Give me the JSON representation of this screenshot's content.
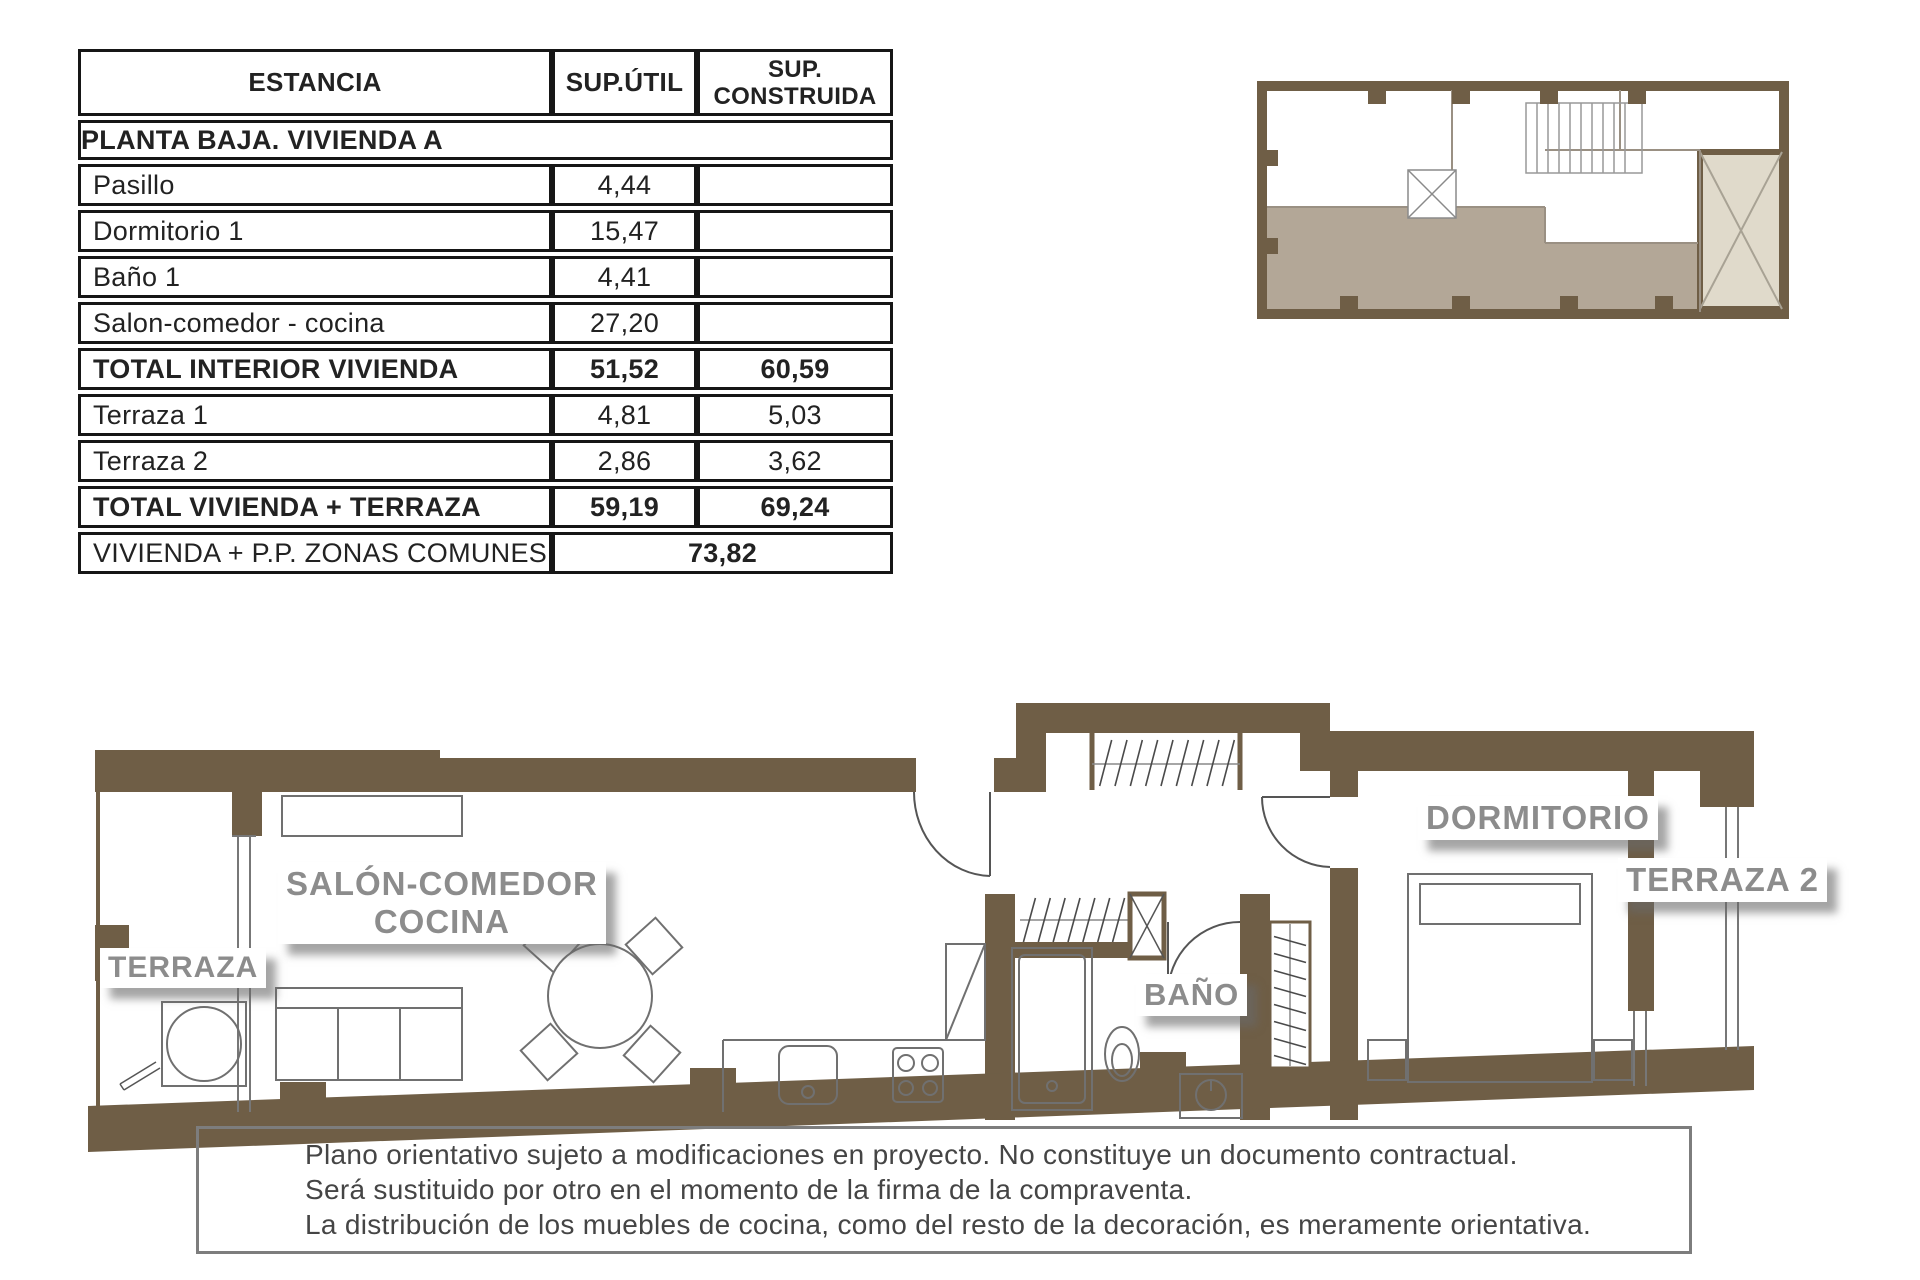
{
  "area_table": {
    "col_headers": {
      "estancia": "ESTANCIA",
      "sup_util": "SUP.ÚTIL",
      "sup_construida": "SUP. CONSTRUIDA"
    },
    "section_header": "PLANTA BAJA.    VIVIENDA A",
    "rows": [
      {
        "label": "Pasillo",
        "util": "4,44",
        "construida": "",
        "bold": false
      },
      {
        "label": "Dormitorio 1",
        "util": "15,47",
        "construida": "",
        "bold": false
      },
      {
        "label": "Baño 1",
        "util": "4,41",
        "construida": "",
        "bold": false
      },
      {
        "label": "Salon-comedor - cocina",
        "util": "27,20",
        "construida": "",
        "bold": false
      },
      {
        "label": "TOTAL INTERIOR VIVIENDA",
        "util": "51,52",
        "construida": "60,59",
        "bold": true
      },
      {
        "label": "Terraza 1",
        "util": "4,81",
        "construida": "5,03",
        "bold": false
      },
      {
        "label": "Terraza 2",
        "util": "2,86",
        "construida": "3,62",
        "bold": false
      },
      {
        "label": "TOTAL VIVIENDA + TERRAZA",
        "util": "59,19",
        "construida": "69,24",
        "bold": true
      }
    ],
    "footer_row": {
      "label": "VIVIENDA + P.P. ZONAS COMUNES",
      "value": "73,82"
    }
  },
  "floor_plan": {
    "labels": {
      "terraza": "TERRAZA",
      "salon_line1": "SALÓN-COMEDOR",
      "salon_line2": "COCINA",
      "bano": "BAÑO",
      "dormitorio": "DORMITORIO",
      "terraza2": "TERRAZA 2"
    }
  },
  "disclaimer": {
    "lines": [
      "Plano orientativo sujeto a modificaciones en proyecto. No constituye un documento contractual.",
      "Será sustituido por otro en el momento de la firma de la compraventa.",
      "La distribución de los muebles de cocina, como del resto de la decoración, es meramente orientativa."
    ]
  },
  "colors": {
    "wall": "#6F5E46",
    "keyplan_highlight": "#B3A797",
    "keyplan_patio": "#E0DACB",
    "label_text": "#8C8C8C",
    "table_border": "#161616",
    "furniture_line": "#707070"
  }
}
